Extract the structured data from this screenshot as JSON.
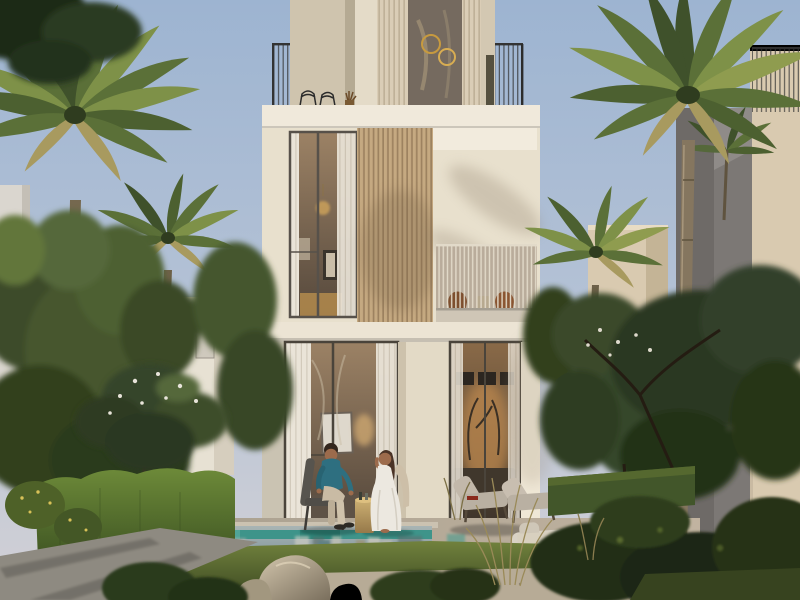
{
  "scene": {
    "people_count": 2,
    "buildings_visible": 4,
    "palm_trees_visible": 5
  },
  "colors": {
    "sky_top": "#9db4d1",
    "sky_mid": "#b6c3d6",
    "sky_horizon": "#d3d1d6",
    "facade": "#e8e0cd",
    "facade_bright": "#f0e9db",
    "band": "#ece4d4",
    "wood_slat": "#c5a981",
    "wood_slat_line": "#9d8260",
    "slat_cream": "#dacdb6",
    "slat_cream_line": "#bcae94",
    "glass_dark": "#756a5f",
    "window_frame": "#4a443b",
    "interior_warm": "#a2866a",
    "interior_glow": "#c08a4f",
    "curtain": "#eae4d8",
    "rail_dark": "#333333",
    "rail_light": "#e2dac9",
    "side_wall": "#8f8b88",
    "side_wall_dark": "#6e6a67",
    "neighbor_beige": "#d9cab0",
    "bg_villa": "#e7e1d3",
    "low_wall": "#ddd7c9",
    "pool_teal": "#3e948a",
    "pool_surface_top": "#a9b5b4",
    "pool_surface_bottom": "#7e939b",
    "coping": "#cbc2b1",
    "deck": "#a89f8f",
    "deck_lit": "#c1b3a0",
    "path": "#8e8a81",
    "gravel": "#b7ab96",
    "lawn_lit": "#71823d",
    "lawn_dark": "#3a4621",
    "hedge_lit": "#6d8a39",
    "hedge_dark": "#3f5523",
    "tree_dark": "#2c3a1f",
    "tree_mid": "#44562c",
    "tree_light": "#62763a",
    "palm_dark": "#3f512b",
    "palm_mid": "#5b7038",
    "palm_light": "#7e9148",
    "palm_dry": "#a89a5f",
    "trunk": "#85765f",
    "trunk_dark": "#665843",
    "rock_light": "#d3c6ad",
    "rock_dark": "#7a6f5d",
    "skin": "#9c6b4c",
    "shirt_teal": "#2e6f80",
    "pants": "#c9bba4",
    "dress_white": "#ece8e0",
    "hair_dark": "#33261d",
    "hair_brown": "#4a3326",
    "table_gold_light": "#ccaf72",
    "table_gold_dark": "#96794a",
    "lounger": "#b9b0a2",
    "rust_chair": "#7d4f2e",
    "step_light": "#d8d0bf",
    "bush_dark": "#243018",
    "grass_wisp": "#9a8a58"
  }
}
